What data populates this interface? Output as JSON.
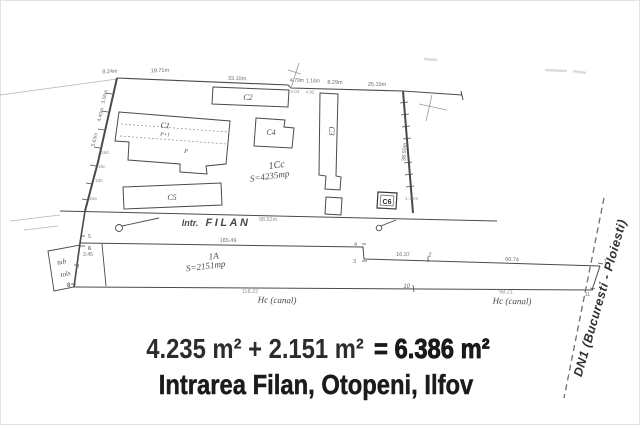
{
  "plan": {
    "street": {
      "prefix": "Intr.",
      "name": "FILAN",
      "length": "98.52m"
    },
    "parcel_upper": {
      "id": "1Cc",
      "area": "S=4235mp"
    },
    "parcel_lower": {
      "id": "1A",
      "area": "S=2151mp"
    },
    "buildings": {
      "c1": "C1",
      "c1_storeys": "P+1",
      "c1_note": "P",
      "c2": "C2",
      "c3": "C3",
      "c4": "C4",
      "c5": "C5",
      "c6": "C6",
      "c6_dim": "1.79m"
    },
    "dims_top": {
      "d1": "8.24m",
      "d2": "19.71m",
      "d3": "33.10m",
      "d4": "4.79m",
      "d5": "1.14m",
      "d6": "8.29m",
      "d7": "25.19m"
    },
    "dims_top_small": {
      "s1": "4.04",
      "s2": "4.92"
    },
    "dims_left": {
      "d1": "3.06m",
      "d2": "4.40m",
      "d3": "5.63m"
    },
    "left_marks": {
      "m1": "18d",
      "m2": "18c",
      "m3": "18b",
      "m4": "18a"
    },
    "dim_right": "38.50m",
    "dims_strip": {
      "len_road": "165.49",
      "len_a": "2.45",
      "len_b": "16.37",
      "len_c": "60.74",
      "len_d": "118.22",
      "len_e": "98.21"
    },
    "canal1": "Hc (canal)",
    "canal2": "Hc (canal)",
    "points": {
      "p1": "1",
      "p2": "2",
      "p3": "3",
      "p4": "4",
      "p5": "5",
      "p6": "6",
      "p8": "8",
      "p9": "9",
      "p10": "10",
      "p11": "11"
    },
    "side_note1": "tub",
    "side_note2": "tols",
    "highway": "DN1 (Bucuresti - Ploiesti)"
  },
  "caption": {
    "sum_operands": "4.235 m² + 2.151 m²",
    "sum_result": "= 6.386 m²",
    "address": "Intrarea Filan, Otopeni, Ilfov"
  },
  "colors": {
    "ink": "#4a4a4a",
    "faint": "#b3b3b3",
    "caption": "#1b1b1d"
  }
}
